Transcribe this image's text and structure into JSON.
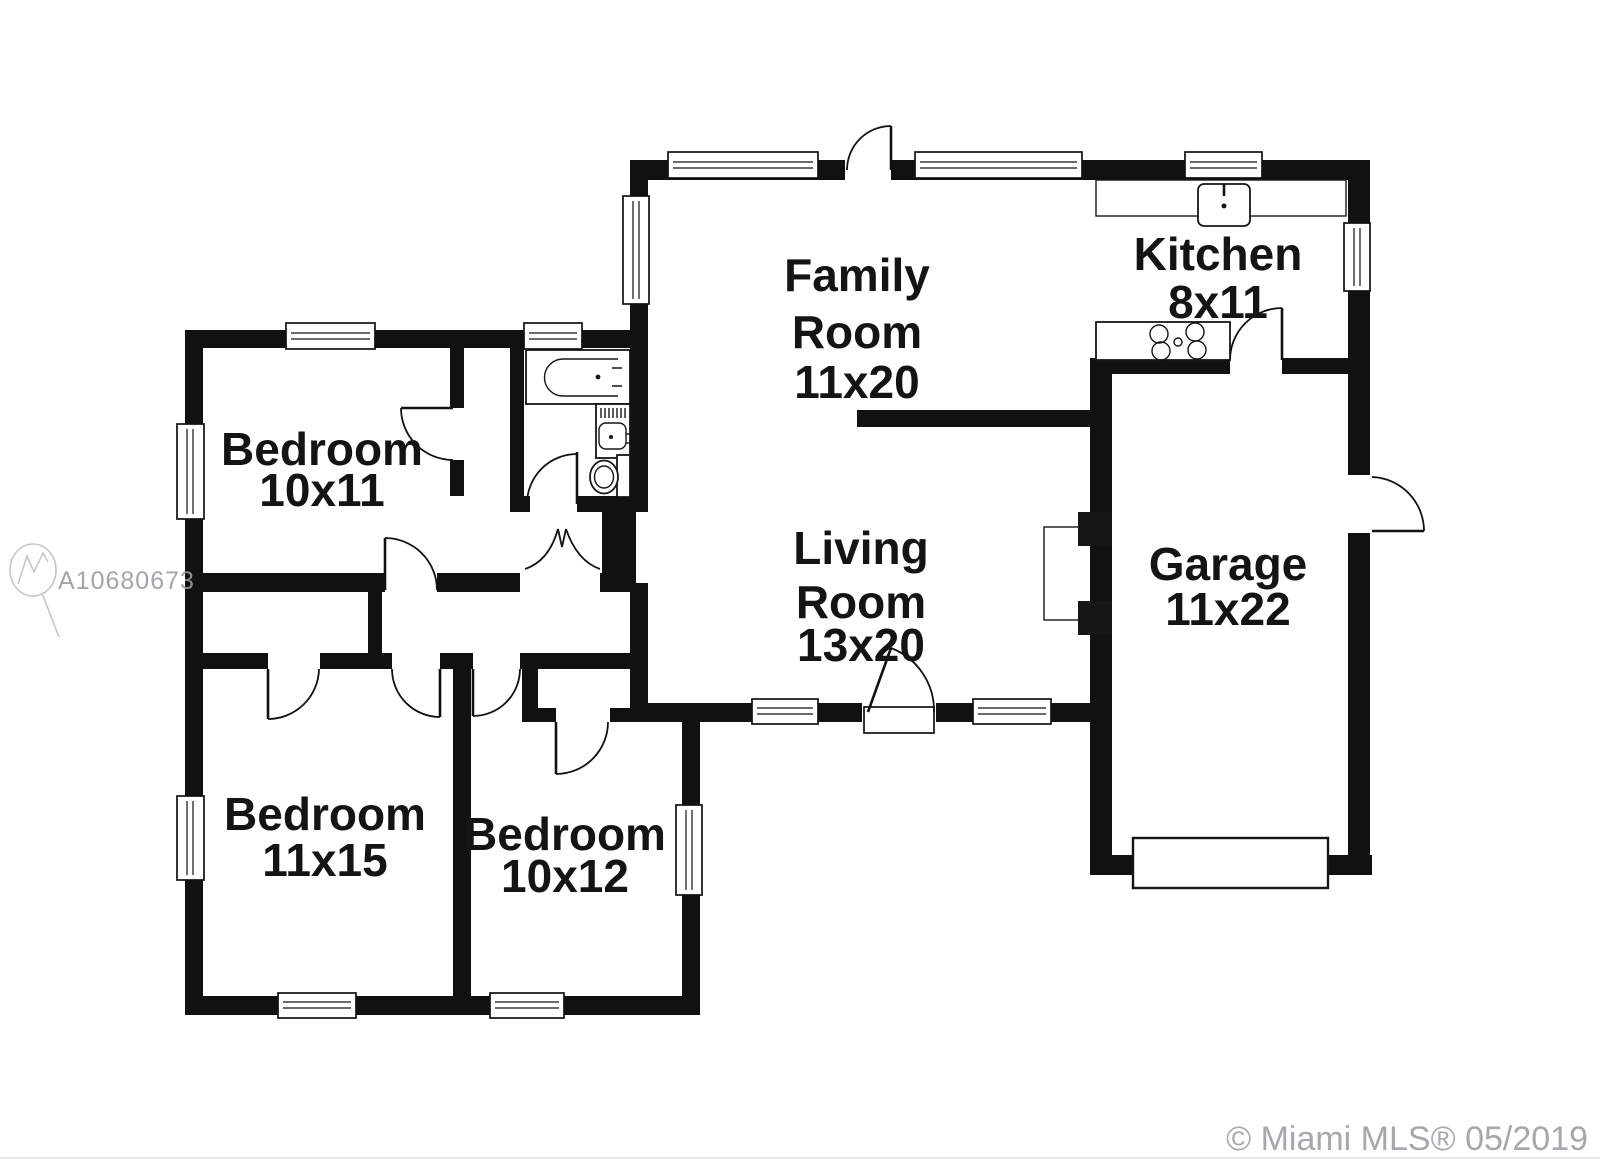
{
  "document": {
    "type": "residential-floor-plan",
    "background": "#ffffff"
  },
  "colors": {
    "wall": "#111111",
    "label": "#141414",
    "watermark": "#9b9ba1",
    "copyright": "#a7a7ac"
  },
  "rooms": {
    "family_room": {
      "label": "Family",
      "label2": "Room",
      "dims": "11x20"
    },
    "living_room": {
      "label": "Living",
      "label2": "Room",
      "dims": "13x20"
    },
    "kitchen": {
      "label": "Kitchen",
      "dims": "8x11"
    },
    "garage": {
      "label": "Garage",
      "dims": "11x22"
    },
    "bedroom_1": {
      "label": "Bedroom",
      "dims": "10x11"
    },
    "bedroom_2": {
      "label": "Bedroom",
      "dims": "11x15"
    },
    "bedroom_3": {
      "label": "Bedroom",
      "dims": "10x12"
    }
  },
  "fixtures": {
    "bathtub": "bathtub",
    "vanity_sink": "vanity-sink",
    "toilet": "toilet",
    "kitchen_sink": "kitchen-sink",
    "range_cooktop": "range-cooktop",
    "fireplace": "fireplace",
    "garage_door": "garage-door"
  },
  "watermark": {
    "id": "A10680673",
    "logo": "miami-mls-logo"
  },
  "copyright": {
    "text": "© Miami MLS® 05/2019"
  }
}
